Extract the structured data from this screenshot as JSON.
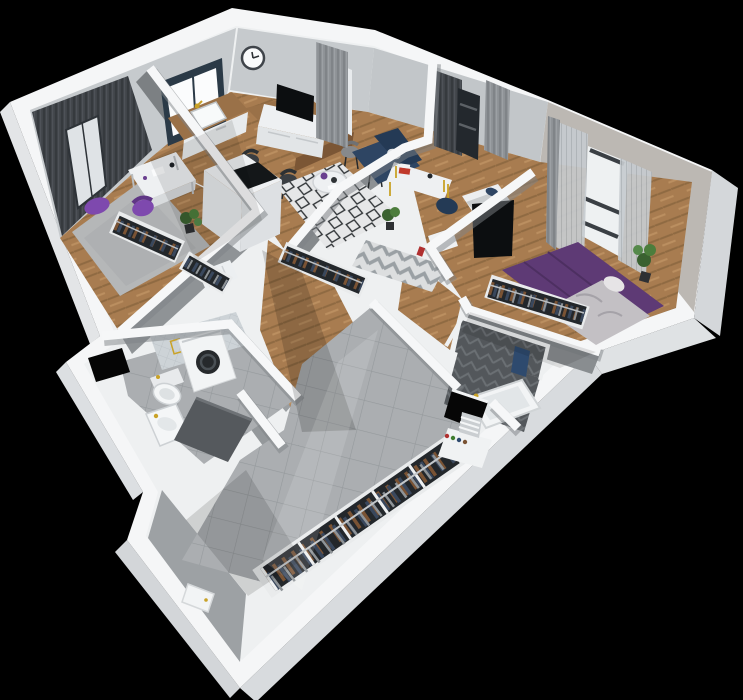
{
  "scene": {
    "title": "3D isometric cutaway floor plan of an apartment",
    "type": "3d-floorplan-render",
    "background": "#000000"
  },
  "palette": {
    "background": "#000000",
    "wallTop": "#f5f6f7",
    "wallInner": "#eef0f1",
    "wallFaceLight": "#c6cacd",
    "wallFaceBeige": "#bcb8b3",
    "wallFaceMid": "#9b9fa2",
    "wallFaceDark": "#7c8083",
    "exteriorFace": "#dcdfe2",
    "floorWood": "#a87c50",
    "floorWoodDark": "#7c5a36",
    "floorTile": "#abaeb1",
    "wallTileLight": "#cdd3d7",
    "chevronTileDark": "#53575b",
    "bedPurple": "#5e3a75",
    "duvetGray": "#c3c0c4",
    "sofaNavy": "#2e4563",
    "sofaNavyDark": "#243a55",
    "chairPurple": "#7e49ae",
    "furnitureWhite": "#eef0f2",
    "woodFurniture": "#9a7148",
    "tvBlack": "#0c0e10",
    "doorBlack": "#060606",
    "clothesBrown": "#7a5334",
    "clothesNavy": "#39475c",
    "clothesGray": "#8e9397",
    "wardrobeDark": "#23272b",
    "gold": "#c9a227",
    "plantGreen": "#4c7d3c",
    "plantGreenDark": "#3a6130",
    "curtainGray": "#8e9296",
    "curtainDark": "#41454a",
    "rugGray": "#b5b7b8",
    "washerDoor": "#26292c",
    "towelBlue": "#2e4a6e",
    "redAccent": "#b03030",
    "vanityDark": "#55595d"
  },
  "rooms": [
    {
      "id": "bedroom-2",
      "label": "Bedroom / home office (left)",
      "floor": "wood with gray rug",
      "furniture": [
        "white desk",
        "purple desk chair",
        "purple floor cushion",
        "open wardrobe with clothes",
        "second hanging rail",
        "white radiator",
        "potted plant",
        "floor-to-ceiling dark curtains",
        "balcony window"
      ]
    },
    {
      "id": "kitchen",
      "label": "Kitchen",
      "floor": "wood herringbone",
      "furniture": [
        "dark framed window",
        "wall clock",
        "wood countertop with white cabinets",
        "sink with brass faucet",
        "island with dark cooktop",
        "wooden breakfast bar",
        "two dark bar chairs",
        "two gray bar chairs",
        "green fruit bowl"
      ]
    },
    {
      "id": "living-room",
      "label": "Living room",
      "floor": "wood herringbone",
      "furniture": [
        "TV on white sideboard",
        "navy sofa with white cushion",
        "round white coffee table",
        "purple vase",
        "black and white diamond rug",
        "sheer gray curtains"
      ]
    },
    {
      "id": "kids-room",
      "label": "Kids room / study",
      "floor": "wood herringbone",
      "furniture": [
        "white desk with brass legs",
        "red books",
        "navy pouf",
        "single bed with navy pillow",
        "gray chevron rug",
        "open wardrobe rail",
        "potted plant",
        "curtained window"
      ]
    },
    {
      "id": "master-bedroom",
      "label": "Master bedroom",
      "floor": "wood herringbone",
      "furniture": [
        "double bed with purple bedding",
        "crumpled gray duvet",
        "wall-mounted TV",
        "white media bench",
        "open wardrobe rail",
        "tall potted plant",
        "large window with sheer curtains"
      ]
    },
    {
      "id": "bathroom",
      "label": "Bathroom",
      "floor": "gray tile",
      "furniture": [
        "washing machine",
        "wall-hung toilet",
        "washbasin with brass faucet",
        "dark vanity partition",
        "light tiled walls",
        "black ventilation shaft"
      ]
    },
    {
      "id": "shower-room",
      "label": "Shower room",
      "floor": "dark chevron tile",
      "furniture": [
        "bathtub with brass faucet",
        "navy towel",
        "dark chevron tiled walls",
        "black open doorway"
      ]
    },
    {
      "id": "hallway",
      "label": "Entry hall",
      "floor": "large gray tiles",
      "furniture": [
        "long open wardrobe full of clothes",
        "white end platform",
        "stack of shoe boxes",
        "row of shoes",
        "entry door with brass handle"
      ]
    },
    {
      "id": "corridor",
      "label": "Corridor",
      "floor": "wood herringbone",
      "furniture": [
        "open hanging rail with clothes",
        "red floor accent"
      ]
    }
  ]
}
